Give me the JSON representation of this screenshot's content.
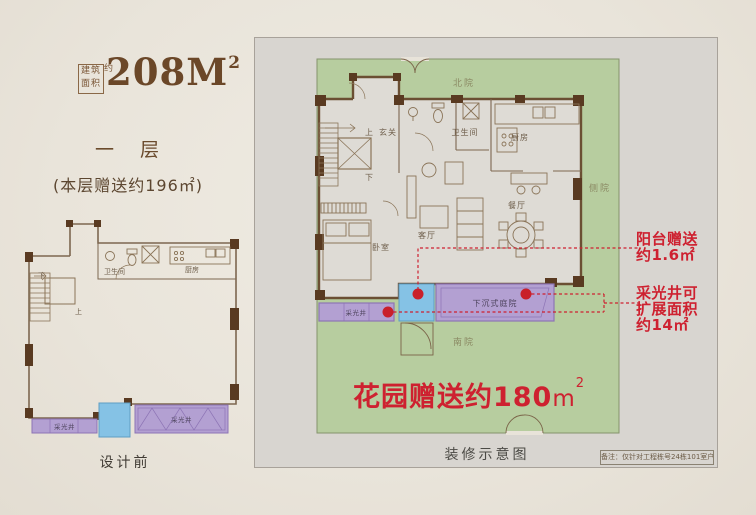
{
  "header": {
    "seal_row1": "建筑",
    "seal_row2": "面积",
    "seal_approx": "约",
    "area_value": "208M",
    "area_sup": "2",
    "floor_label": "一 层",
    "floor_gift": "(本层赠送约196㎡)"
  },
  "left_plan": {
    "caption": "设计前",
    "labels": {
      "down": "下",
      "up": "上",
      "bathroom": "卫生间",
      "kitchen": "厨房",
      "lightwell_left": "采光井",
      "lightwell_right": "采光井"
    }
  },
  "right_plan": {
    "caption": "装修示意图",
    "note": "备注：仅针对工程栋号24栋101室户型",
    "yards": {
      "north": "北院",
      "side": "侧院",
      "south": "南院"
    },
    "rooms": {
      "up": "上",
      "entry": "玄关",
      "down": "下",
      "bathroom": "卫生间",
      "kitchen": "厨房",
      "bedroom": "卧室",
      "living": "客厅",
      "dining": "餐厅",
      "lightwell": "采光井",
      "sunken_courtyard": "下沉式庭院"
    },
    "garden_gift": {
      "text": "花园赠送约180",
      "unit": "m",
      "sup": "2"
    },
    "annotations": {
      "balcony": {
        "line1": "阳台赠送",
        "line2": "约1.6㎡"
      },
      "lightwell": {
        "line1": "采光井可",
        "line2": "扩展面积",
        "line3": "约14㎡"
      }
    },
    "colors": {
      "garden": "#b7cd9f",
      "purple": "#b3a0d2",
      "blue": "#85c2e5",
      "red": "#ce2130",
      "wall": "#6b4f33"
    }
  }
}
